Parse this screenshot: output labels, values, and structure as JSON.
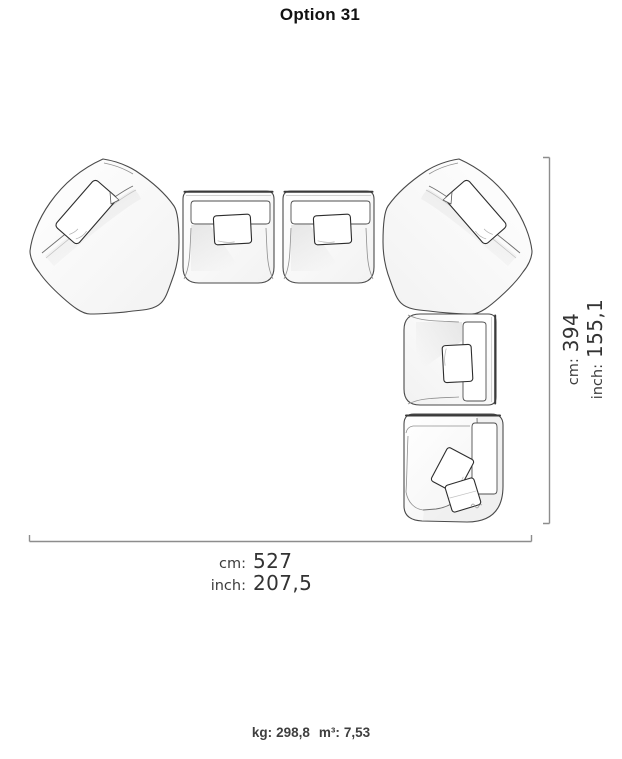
{
  "title": "Option 31",
  "dimensions": {
    "vertical": {
      "cm_label": "cm:",
      "cm_value": "394",
      "inch_label": "inch:",
      "inch_value": "155,1"
    },
    "horizontal": {
      "cm_label": "cm:",
      "cm_value": "527",
      "inch_label": "inch:",
      "inch_value": "207,5"
    }
  },
  "specs": {
    "kg_label": "kg:",
    "kg_value": "298,8",
    "m3_label": "m³:",
    "m3_value": "7,53"
  },
  "diagram": {
    "modules": [
      {
        "id": "corner-module-left",
        "label": "angled corner module"
      },
      {
        "id": "seat-module-1",
        "label": "armless seat module"
      },
      {
        "id": "seat-module-2",
        "label": "armless seat module"
      },
      {
        "id": "corner-module-right",
        "label": "angled corner module"
      },
      {
        "id": "seat-module-3",
        "label": "armless seat module rotated"
      },
      {
        "id": "end-module",
        "label": "corner end module with arm"
      }
    ]
  }
}
